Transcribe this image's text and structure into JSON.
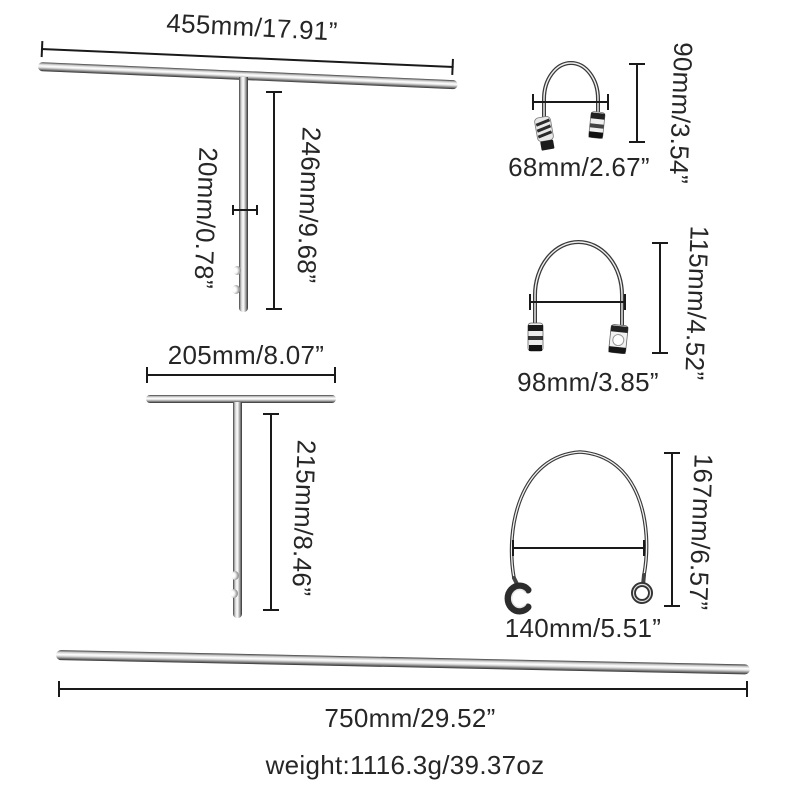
{
  "diagram": {
    "background": "#ffffff",
    "text_color": "#262626",
    "line_color": "#1a1a1a",
    "metal_highlight": "#ffffff",
    "metal_shadow": "#2e2e2e",
    "t_handle_large": {
      "width": "455mm/17.91”",
      "height": "246mm/9.68”",
      "diameter": "20mm/0.78”"
    },
    "u_bow_small": {
      "width": "68mm/2.67”",
      "height": "90mm/3.54”"
    },
    "u_bow_medium": {
      "width": "98mm/3.85”",
      "height": "115mm/4.52”"
    },
    "t_handle_small": {
      "width": "205mm/8.07”",
      "height": "215mm/8.46”"
    },
    "u_bow_large": {
      "width": "140mm/5.51”",
      "height": "167mm/6.57”"
    },
    "rod": {
      "length": "750mm/29.52”"
    },
    "weight": "weight:1116.3g/39.37oz"
  }
}
